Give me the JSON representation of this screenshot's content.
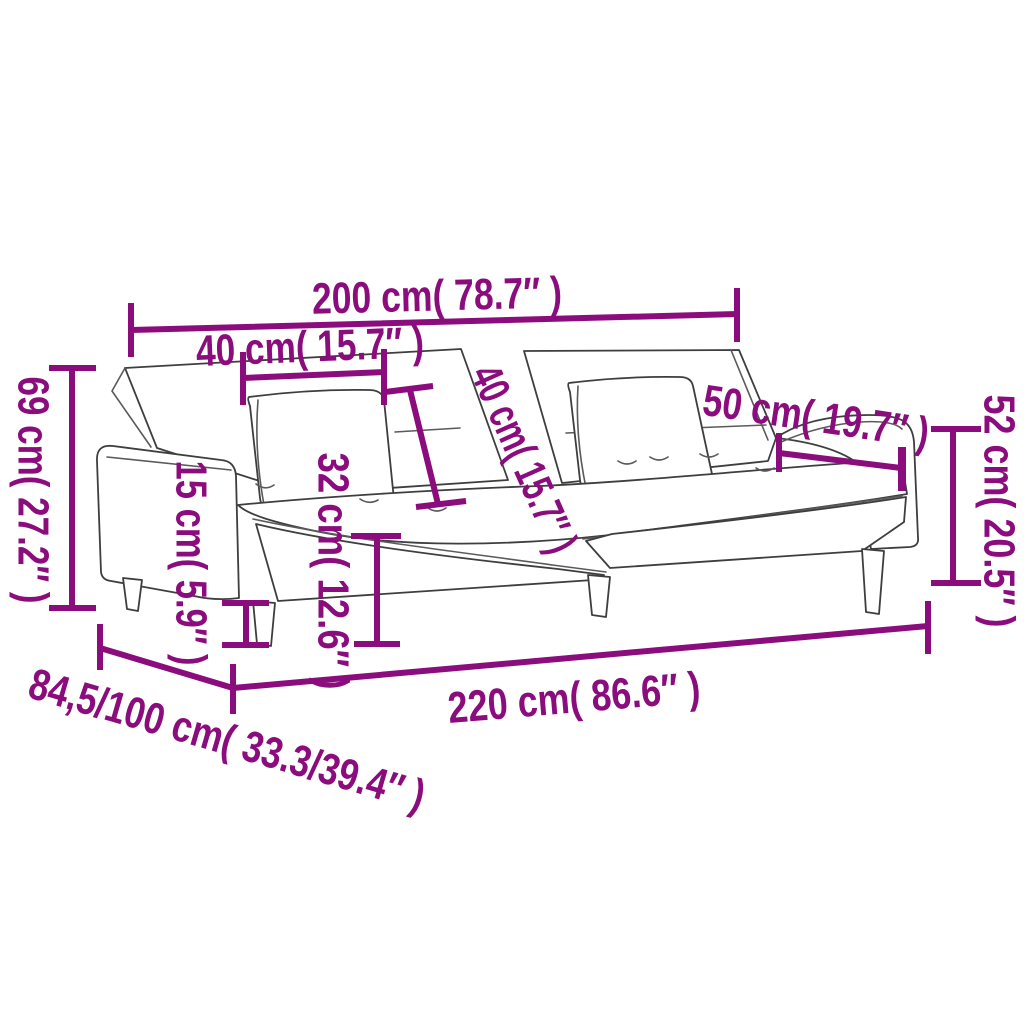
{
  "style": {
    "accent_color": "#8B0C7D",
    "line_color": "#3E3E3E",
    "background": "#FFFFFF"
  },
  "figure": {
    "subject": "sofa-bed-line-drawing"
  },
  "dimensions": [
    {
      "id": "back-width",
      "label": "200 cm( 78.7″ )",
      "cm": "200",
      "inches": "78.7"
    },
    {
      "id": "pillow-width",
      "label": "40 cm( 15.7″ )",
      "cm": "40",
      "inches": "15.7"
    },
    {
      "id": "back-height",
      "label": "69 cm( 27.2″ )",
      "cm": "69",
      "inches": "27.2"
    },
    {
      "id": "leg-height",
      "label": "15 cm( 5.9″ )",
      "cm": "15",
      "inches": "5.9"
    },
    {
      "id": "seat-height",
      "label": "32 cm( 12.6″ )",
      "cm": "32",
      "inches": "12.6"
    },
    {
      "id": "backrest-size",
      "label": "40 cm( 15.7″ )",
      "cm": "40",
      "inches": "15.7"
    },
    {
      "id": "armrest-length",
      "label": "50 cm( 19.7″ )",
      "cm": "50",
      "inches": "19.7"
    },
    {
      "id": "arm-height",
      "label": "52 cm( 20.5″ )",
      "cm": "52",
      "inches": "20.5"
    },
    {
      "id": "total-length",
      "label": "220 cm( 86.6″ )",
      "cm": "220",
      "inches": "86.6"
    },
    {
      "id": "depth",
      "label": "84,5/100 cm( 33.3/39.4″ )",
      "cm": "84,5/100",
      "inches": "33.3/39.4"
    }
  ]
}
